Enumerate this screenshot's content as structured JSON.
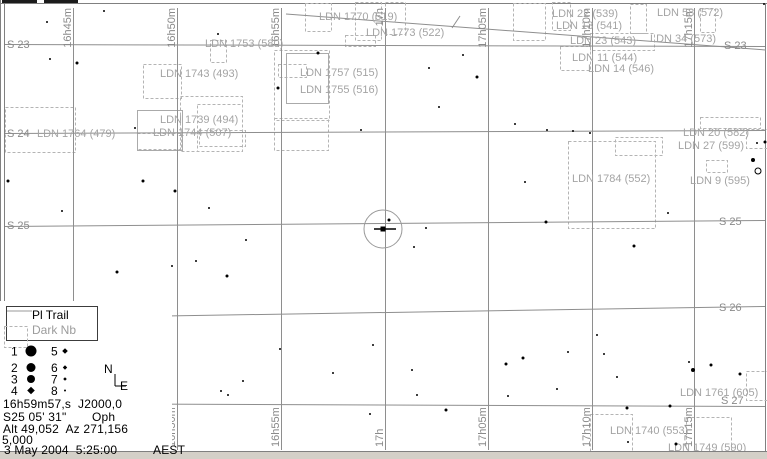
{
  "colors": {
    "grid": "#8e8e8e",
    "grid_label": "#8a8a8a",
    "nebula_label": "#a4a4a4",
    "dashed_box": "#b4b4b4",
    "star": "#000000",
    "border": "#808080",
    "band": "#d4d0c8"
  },
  "grid": {
    "ra_lines": [
      {
        "x": 73,
        "label": "16h45m",
        "show_top": true,
        "show_bottom": false
      },
      {
        "x": 177,
        "label": "16h50m",
        "show_top": true,
        "show_bottom": true
      },
      {
        "x": 281,
        "label": "16h55m",
        "show_top": true,
        "show_bottom": true
      },
      {
        "x": 385,
        "label": "17h",
        "show_top": true,
        "show_bottom": true
      },
      {
        "x": 488,
        "label": "17h05m",
        "show_top": true,
        "show_bottom": true
      },
      {
        "x": 592,
        "label": "17h10m",
        "show_top": true,
        "show_bottom": true
      },
      {
        "x": 694,
        "label": "17h15m",
        "show_top": true,
        "show_bottom": true
      }
    ],
    "dec_lines": [
      {
        "left_y": 44,
        "right_y": 46
      },
      {
        "left_y": 133,
        "right_y": 130
      },
      {
        "left_y": 226,
        "right_y": 220
      },
      {
        "left_y": 318,
        "right_y": 306
      },
      {
        "left_y": 403,
        "right_y": 406
      }
    ],
    "dec_labels": [
      {
        "text": "S 23",
        "x": 7,
        "y": 48
      },
      {
        "text": "S 24",
        "x": 7,
        "y": 137
      },
      {
        "text": "S 25",
        "x": 7,
        "y": 229
      },
      {
        "text": "S 23",
        "x": 724,
        "y": 49
      },
      {
        "text": "S 25",
        "x": 719,
        "y": 225
      },
      {
        "text": "S 26",
        "x": 719,
        "y": 311
      },
      {
        "text": "S 27",
        "x": 721,
        "y": 404
      }
    ]
  },
  "trail": {
    "x1": 286,
    "y1": 14,
    "x2": 766,
    "y2": 50,
    "tick": [
      452,
      28,
      460,
      16
    ]
  },
  "target": {
    "cx": 383,
    "cy": 229,
    "r": 19,
    "dash_x1": 374,
    "dash_x2": 396
  },
  "nebulae": {
    "labels": [
      {
        "text": "LDN 1764 (479)",
        "x": 37,
        "y": 137
      },
      {
        "text": "LDN 1743 (493)",
        "x": 160,
        "y": 77
      },
      {
        "text": "LDN 1739 (494)",
        "x": 160,
        "y": 123
      },
      {
        "text": "LDN 1744 (507)",
        "x": 153,
        "y": 136
      },
      {
        "text": "LDN 1753 (580)",
        "x": 205,
        "y": 47
      },
      {
        "text": "LDN 1757 (515)",
        "x": 300,
        "y": 76
      },
      {
        "text": "LDN 1755 (516)",
        "x": 300,
        "y": 93
      },
      {
        "text": "LDN 1770 (519)",
        "x": 319,
        "y": 20
      },
      {
        "text": "LDN 1773 (522)",
        "x": 366,
        "y": 36
      },
      {
        "text": "LDN 22 (539)",
        "x": 552,
        "y": 17
      },
      {
        "text": "LDN 13 (541)",
        "x": 556,
        "y": 29
      },
      {
        "text": "LDN 23 (543)",
        "x": 570,
        "y": 44
      },
      {
        "text": "LDN 11 (544)",
        "x": 572,
        "y": 61
      },
      {
        "text": "LDN 14 (546)",
        "x": 588,
        "y": 72
      },
      {
        "text": "LDN 58 (572)",
        "x": 657,
        "y": 16
      },
      {
        "text": "LDN 34 (573)",
        "x": 650,
        "y": 42
      },
      {
        "text": "LDN 20 (582)",
        "x": 683,
        "y": 136
      },
      {
        "text": "LDN 27 (599)",
        "x": 678,
        "y": 149
      },
      {
        "text": "LDN 9 (595)",
        "x": 690,
        "y": 184
      },
      {
        "text": "LDN 1784 (552)",
        "x": 572,
        "y": 182
      },
      {
        "text": "LDN 1761 (605)",
        "x": 680,
        "y": 396
      },
      {
        "text": "LDN 1740 (553)",
        "x": 610,
        "y": 434
      },
      {
        "text": "LDN 1749 (590)",
        "x": 668,
        "y": 451
      }
    ],
    "boxes": [
      [
        210,
        40,
        16,
        22
      ],
      [
        143,
        64,
        38,
        34
      ],
      [
        180,
        96,
        62,
        55
      ],
      [
        197,
        104,
        45,
        47
      ],
      [
        5,
        107,
        70,
        45
      ],
      [
        137,
        133,
        44,
        16
      ],
      [
        199,
        130,
        46,
        16
      ],
      [
        274,
        118,
        54,
        32
      ],
      [
        274,
        50,
        55,
        70
      ],
      [
        278,
        64,
        28,
        13
      ],
      [
        305,
        3,
        26,
        28
      ],
      [
        355,
        2,
        26,
        38
      ],
      [
        385,
        2,
        20,
        32
      ],
      [
        345,
        35,
        30,
        11
      ],
      [
        513,
        3,
        32,
        37
      ],
      [
        552,
        2,
        18,
        28
      ],
      [
        630,
        4,
        16,
        29
      ],
      [
        700,
        8,
        15,
        24
      ],
      [
        560,
        46,
        30,
        24
      ],
      [
        590,
        33,
        64,
        17
      ],
      [
        568,
        141,
        87,
        87
      ],
      [
        700,
        117,
        60,
        11
      ],
      [
        615,
        137,
        47,
        18
      ],
      [
        706,
        160,
        21,
        12
      ],
      [
        746,
        129,
        21,
        19
      ],
      [
        590,
        414,
        42,
        44
      ],
      [
        686,
        417,
        45,
        41
      ],
      [
        746,
        371,
        21,
        29
      ]
    ],
    "solid_boxes": [
      [
        286,
        53,
        42,
        50
      ],
      [
        137,
        110,
        45,
        40
      ]
    ],
    "legend_sample_box": [
      4,
      326,
      23,
      21
    ]
  },
  "stars": [
    [
      47,
      22,
      1
    ],
    [
      104,
      11,
      1
    ],
    [
      218,
      34,
      1
    ],
    [
      50,
      59,
      1
    ],
    [
      77,
      63,
      1.5
    ],
    [
      135,
      128,
      1
    ],
    [
      318,
      53,
      1.5
    ],
    [
      278,
      88,
      1.5
    ],
    [
      429,
      68,
      1
    ],
    [
      477,
      77,
      1.5
    ],
    [
      439,
      107,
      1
    ],
    [
      361,
      130,
      1
    ],
    [
      463,
      55,
      1
    ],
    [
      764,
      4,
      1
    ],
    [
      515,
      124,
      1
    ],
    [
      573,
      131,
      1
    ],
    [
      8,
      181,
      1.5
    ],
    [
      143,
      181,
      1.5
    ],
    [
      175,
      191,
      1.5
    ],
    [
      209,
      208,
      1
    ],
    [
      62,
      211,
      1
    ],
    [
      117,
      272,
      1.5
    ],
    [
      227,
      276,
      1.5
    ],
    [
      172,
      266,
      1
    ],
    [
      196,
      261,
      1
    ],
    [
      246,
      240,
      1
    ],
    [
      547,
      130,
      1
    ],
    [
      590,
      133,
      1
    ],
    [
      525,
      182,
      1
    ],
    [
      546,
      222,
      1.5
    ],
    [
      634,
      246,
      1.5
    ],
    [
      668,
      213,
      1
    ],
    [
      389,
      220,
      1.5
    ],
    [
      426,
      228,
      1
    ],
    [
      414,
      247,
      1
    ],
    [
      280,
      349,
      1
    ],
    [
      373,
      345,
      1
    ],
    [
      333,
      373,
      1
    ],
    [
      243,
      381,
      1
    ],
    [
      221,
      391,
      1
    ],
    [
      228,
      395,
      1
    ],
    [
      412,
      370,
      1
    ],
    [
      417,
      395,
      1
    ],
    [
      446,
      410,
      1.5
    ],
    [
      370,
      414,
      1
    ],
    [
      506,
      364,
      1.5
    ],
    [
      523,
      358,
      1.5
    ],
    [
      568,
      352,
      1
    ],
    [
      597,
      335,
      1
    ],
    [
      604,
      354,
      1
    ],
    [
      617,
      377,
      1
    ],
    [
      557,
      389,
      1
    ],
    [
      508,
      396,
      1
    ],
    [
      627,
      408,
      1.5
    ],
    [
      670,
      406,
      1.5
    ],
    [
      693,
      370,
      2
    ],
    [
      711,
      365,
      1.5
    ],
    [
      740,
      374,
      1.5
    ],
    [
      689,
      362,
      1
    ],
    [
      765,
      142,
      1.5
    ],
    [
      757,
      143,
      1
    ],
    [
      753,
      160,
      2
    ],
    [
      676,
      444,
      1.5
    ],
    [
      628,
      442,
      1
    ],
    [
      305,
      457,
      1
    ]
  ],
  "open_circles": [
    [
      758,
      171,
      3
    ]
  ],
  "legend": {
    "pl_trail": "Pl Trail",
    "dark_nb": "Dark Nb",
    "sample_line": [
      7,
      311,
      32,
      311
    ],
    "mag_rows": [
      {
        "left_n": "1",
        "left_sym": "circle",
        "left_r": 5.5,
        "right_n": "5",
        "right_sym": "diamond",
        "right_r": 2.8,
        "y": 351
      },
      {
        "left_n": "2",
        "left_sym": "circle",
        "left_r": 4.5,
        "right_n": "6",
        "right_sym": "diamond",
        "right_r": 2.2,
        "y": 367.5
      },
      {
        "left_n": "3",
        "left_sym": "circle",
        "left_r": 4.0,
        "right_n": "7",
        "right_sym": "diamond",
        "right_r": 1.8,
        "y": 379
      },
      {
        "left_n": "4",
        "left_sym": "diamond",
        "left_r": 3.8,
        "right_n": "8",
        "right_sym": "dot",
        "right_r": 1.0,
        "y": 390.5
      }
    ]
  },
  "compass": {
    "north": "N",
    "east": "E",
    "lines": [
      [
        115,
        374,
        115,
        386
      ],
      [
        115,
        386,
        126,
        386
      ]
    ]
  },
  "status": {
    "ra": "16h59m57,s",
    "epoch": "J2000,0",
    "dec": "S25 05' 31\"",
    "constellation": "Oph",
    "alt_az": "Alt 49,052  Az 271,156",
    "fov": "5,000",
    "date": "3 May 2004  5:25:00",
    "tz": "AEST"
  }
}
